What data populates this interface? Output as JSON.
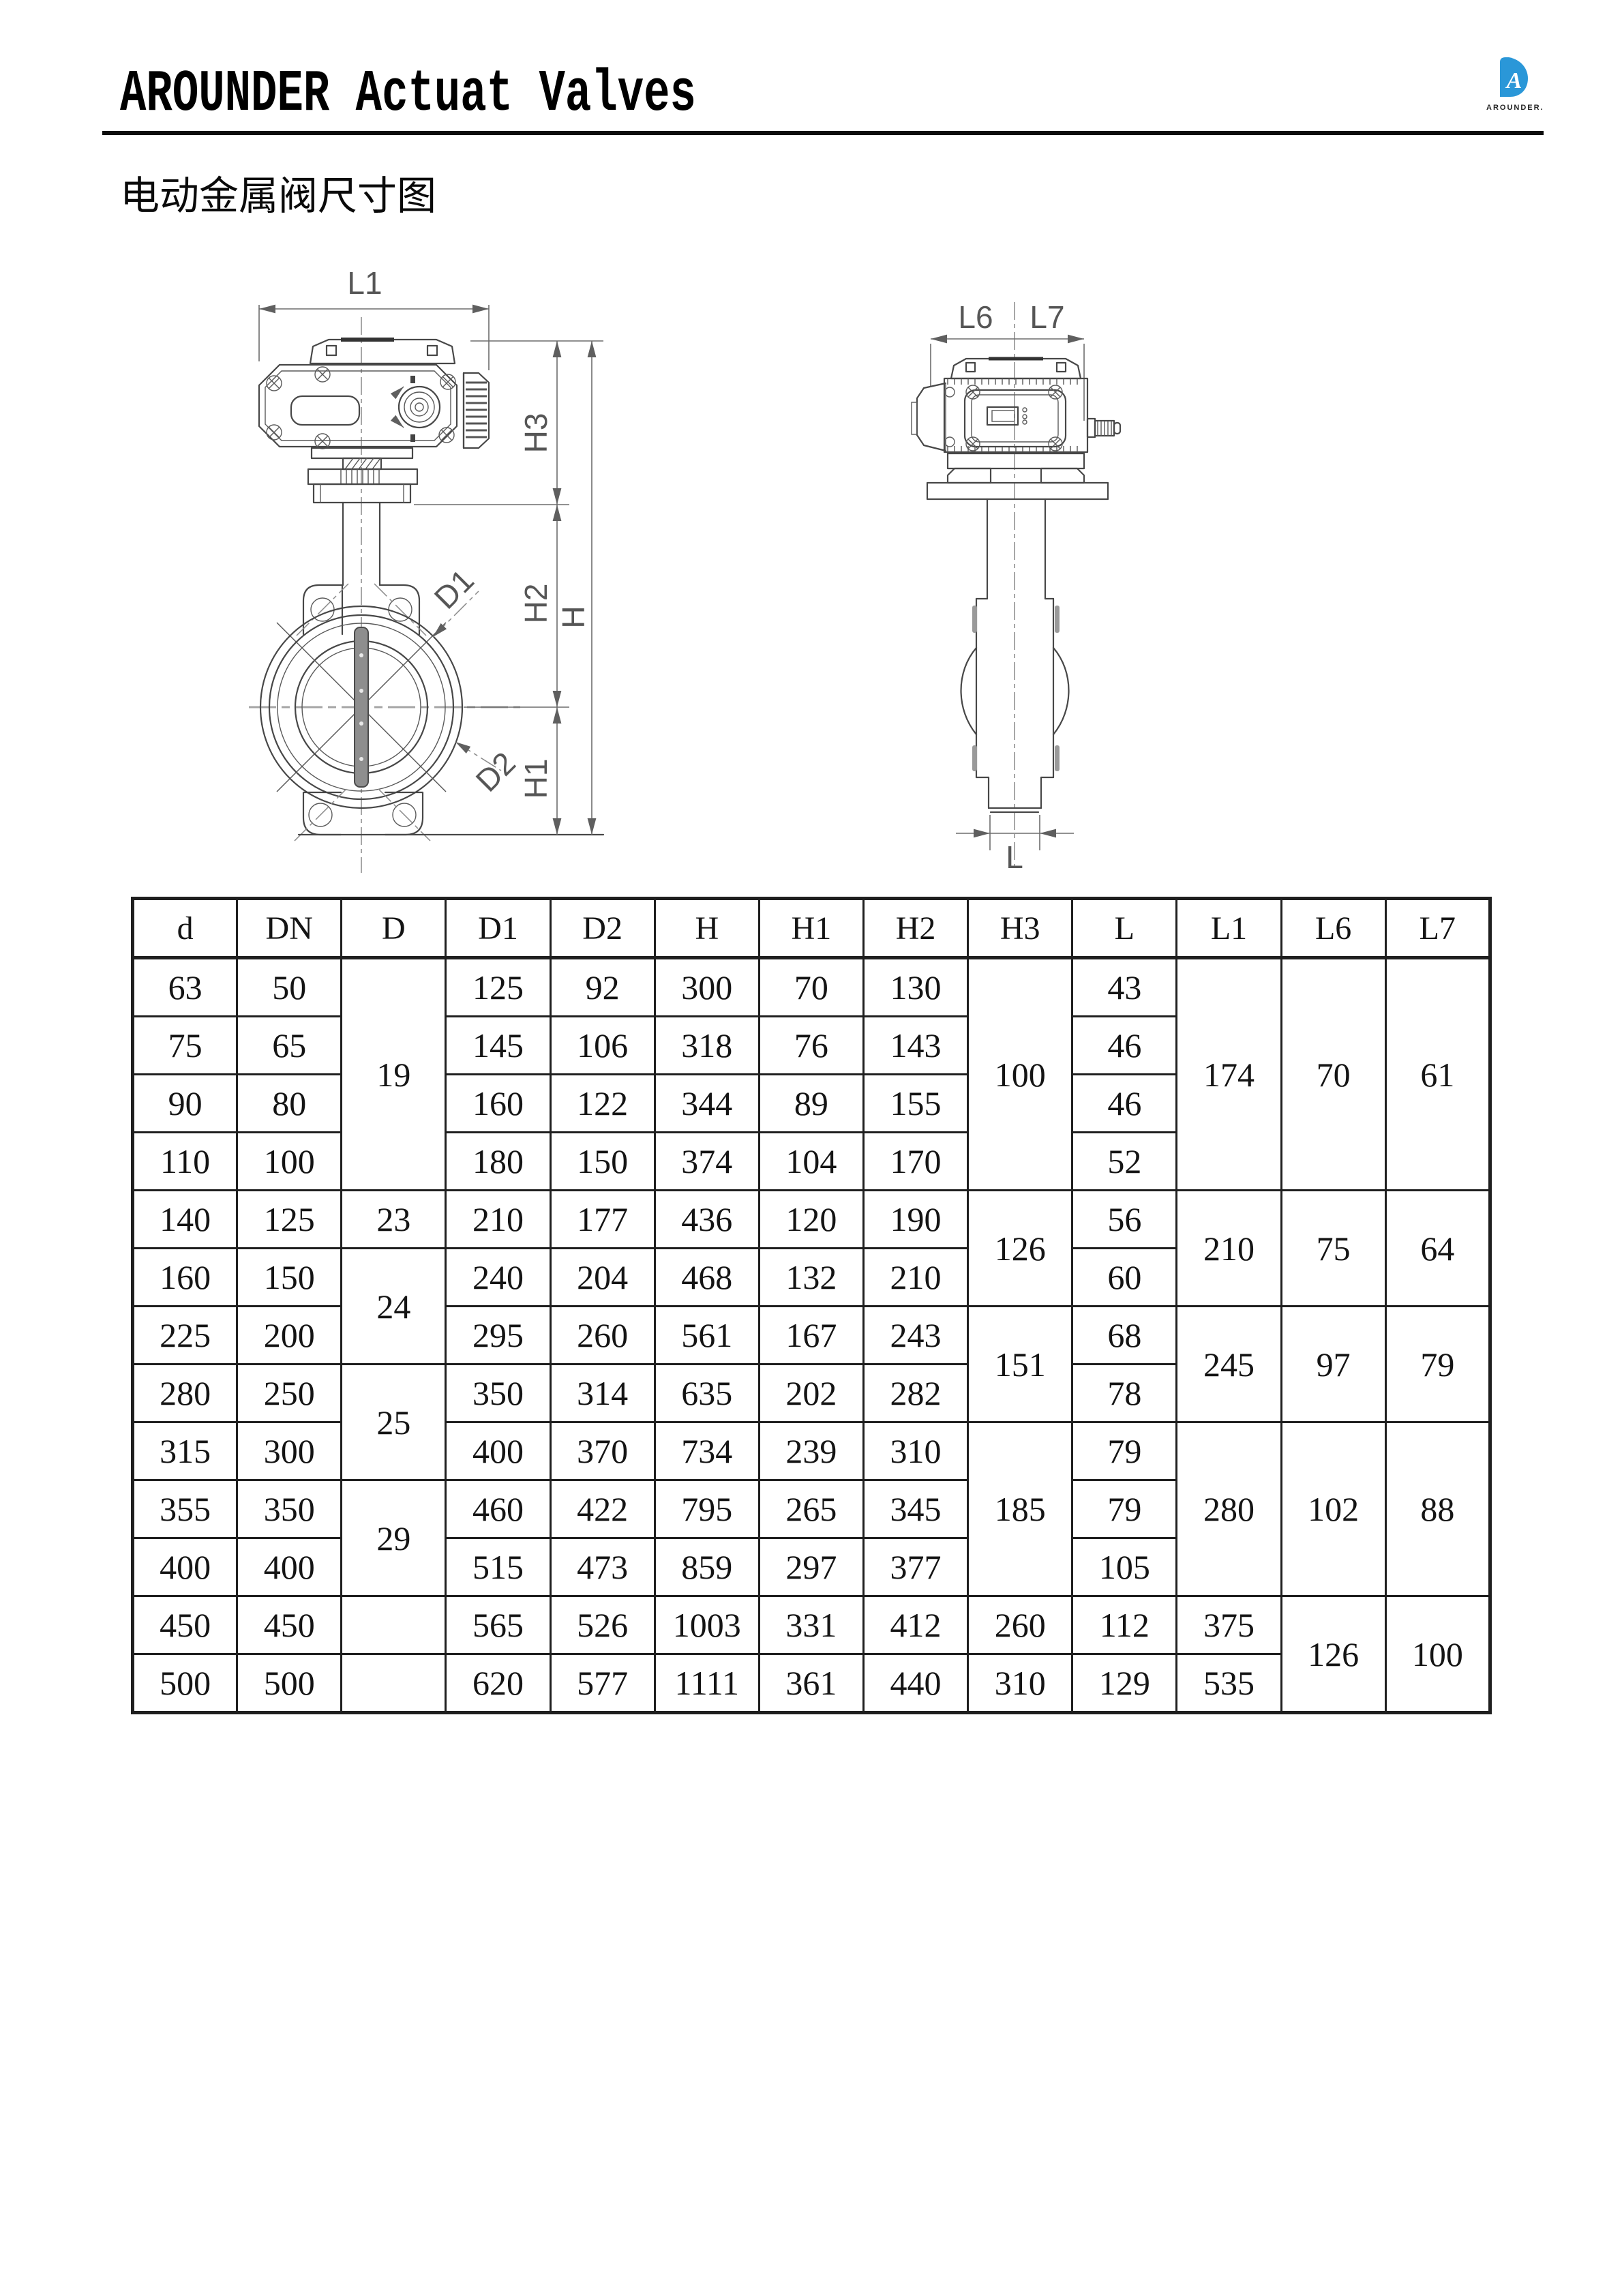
{
  "page": {
    "title": "AROUNDER Actuat Valves",
    "subtitle": "电动金属阀尺寸图"
  },
  "logo": {
    "letter": "A",
    "brand": "AROUNDER.",
    "color": "#2a97d8"
  },
  "front_view": {
    "l1": "L1",
    "h3": "H3",
    "h2": "H2",
    "h": "H",
    "h1": "H1",
    "d1": "D1",
    "d2": "D2"
  },
  "side_view": {
    "l6": "L6",
    "l7": "L7",
    "l": "L"
  },
  "table": {
    "columns": [
      "d",
      "DN",
      "D",
      "D1",
      "D2",
      "H",
      "H1",
      "H2",
      "H3",
      "L",
      "L1",
      "L6",
      "L7"
    ],
    "rows": [
      [
        {
          "v": "63"
        },
        {
          "v": "50"
        },
        {
          "v": "19",
          "rs": 4
        },
        {
          "v": "125"
        },
        {
          "v": "92"
        },
        {
          "v": "300"
        },
        {
          "v": "70"
        },
        {
          "v": "130"
        },
        {
          "v": "100",
          "rs": 4
        },
        {
          "v": "43"
        },
        {
          "v": "174",
          "rs": 4
        },
        {
          "v": "70",
          "rs": 4
        },
        {
          "v": "61",
          "rs": 4
        }
      ],
      [
        {
          "v": "75"
        },
        {
          "v": "65"
        },
        {
          "v": "145"
        },
        {
          "v": "106"
        },
        {
          "v": "318"
        },
        {
          "v": "76"
        },
        {
          "v": "143"
        },
        {
          "v": "46"
        }
      ],
      [
        {
          "v": "90"
        },
        {
          "v": "80"
        },
        {
          "v": "160"
        },
        {
          "v": "122"
        },
        {
          "v": "344"
        },
        {
          "v": "89"
        },
        {
          "v": "155"
        },
        {
          "v": "46"
        }
      ],
      [
        {
          "v": "110"
        },
        {
          "v": "100"
        },
        {
          "v": "180"
        },
        {
          "v": "150"
        },
        {
          "v": "374"
        },
        {
          "v": "104"
        },
        {
          "v": "170"
        },
        {
          "v": "52"
        }
      ],
      [
        {
          "v": "140"
        },
        {
          "v": "125"
        },
        {
          "v": "23"
        },
        {
          "v": "210"
        },
        {
          "v": "177"
        },
        {
          "v": "436"
        },
        {
          "v": "120"
        },
        {
          "v": "190"
        },
        {
          "v": "126",
          "rs": 2
        },
        {
          "v": "56"
        },
        {
          "v": "210",
          "rs": 2
        },
        {
          "v": "75",
          "rs": 2
        },
        {
          "v": "64",
          "rs": 2
        }
      ],
      [
        {
          "v": "160"
        },
        {
          "v": "150"
        },
        {
          "v": "24",
          "rs": 2
        },
        {
          "v": "240"
        },
        {
          "v": "204"
        },
        {
          "v": "468"
        },
        {
          "v": "132"
        },
        {
          "v": "210"
        },
        {
          "v": "60"
        }
      ],
      [
        {
          "v": "225"
        },
        {
          "v": "200"
        },
        {
          "v": "295"
        },
        {
          "v": "260"
        },
        {
          "v": "561"
        },
        {
          "v": "167"
        },
        {
          "v": "243"
        },
        {
          "v": "151",
          "rs": 2
        },
        {
          "v": "68"
        },
        {
          "v": "245",
          "rs": 2
        },
        {
          "v": "97",
          "rs": 2
        },
        {
          "v": "79",
          "rs": 2
        }
      ],
      [
        {
          "v": "280"
        },
        {
          "v": "250"
        },
        {
          "v": "25",
          "rs": 2
        },
        {
          "v": "350"
        },
        {
          "v": "314"
        },
        {
          "v": "635"
        },
        {
          "v": "202"
        },
        {
          "v": "282"
        },
        {
          "v": "78"
        }
      ],
      [
        {
          "v": "315"
        },
        {
          "v": "300"
        },
        {
          "v": "400"
        },
        {
          "v": "370"
        },
        {
          "v": "734"
        },
        {
          "v": "239"
        },
        {
          "v": "310"
        },
        {
          "v": "185",
          "rs": 3
        },
        {
          "v": "79"
        },
        {
          "v": "280",
          "rs": 3
        },
        {
          "v": "102",
          "rs": 3
        },
        {
          "v": "88",
          "rs": 3
        }
      ],
      [
        {
          "v": "355"
        },
        {
          "v": "350"
        },
        {
          "v": "29",
          "rs": 2
        },
        {
          "v": "460"
        },
        {
          "v": "422"
        },
        {
          "v": "795"
        },
        {
          "v": "265"
        },
        {
          "v": "345"
        },
        {
          "v": "79"
        }
      ],
      [
        {
          "v": "400"
        },
        {
          "v": "400"
        },
        {
          "v": "515"
        },
        {
          "v": "473"
        },
        {
          "v": "859"
        },
        {
          "v": "297"
        },
        {
          "v": "377"
        },
        {
          "v": "105"
        }
      ],
      [
        {
          "v": "450"
        },
        {
          "v": "450"
        },
        {
          "v": ""
        },
        {
          "v": "565"
        },
        {
          "v": "526"
        },
        {
          "v": "1003"
        },
        {
          "v": "331"
        },
        {
          "v": "412"
        },
        {
          "v": "260"
        },
        {
          "v": "112"
        },
        {
          "v": "375"
        },
        {
          "v": "126",
          "rs": 2
        },
        {
          "v": "100",
          "rs": 2
        }
      ],
      [
        {
          "v": "500"
        },
        {
          "v": "500"
        },
        {
          "v": ""
        },
        {
          "v": "620"
        },
        {
          "v": "577"
        },
        {
          "v": "1111"
        },
        {
          "v": "361"
        },
        {
          "v": "440"
        },
        {
          "v": "310"
        },
        {
          "v": "129"
        },
        {
          "v": "535"
        }
      ]
    ]
  }
}
